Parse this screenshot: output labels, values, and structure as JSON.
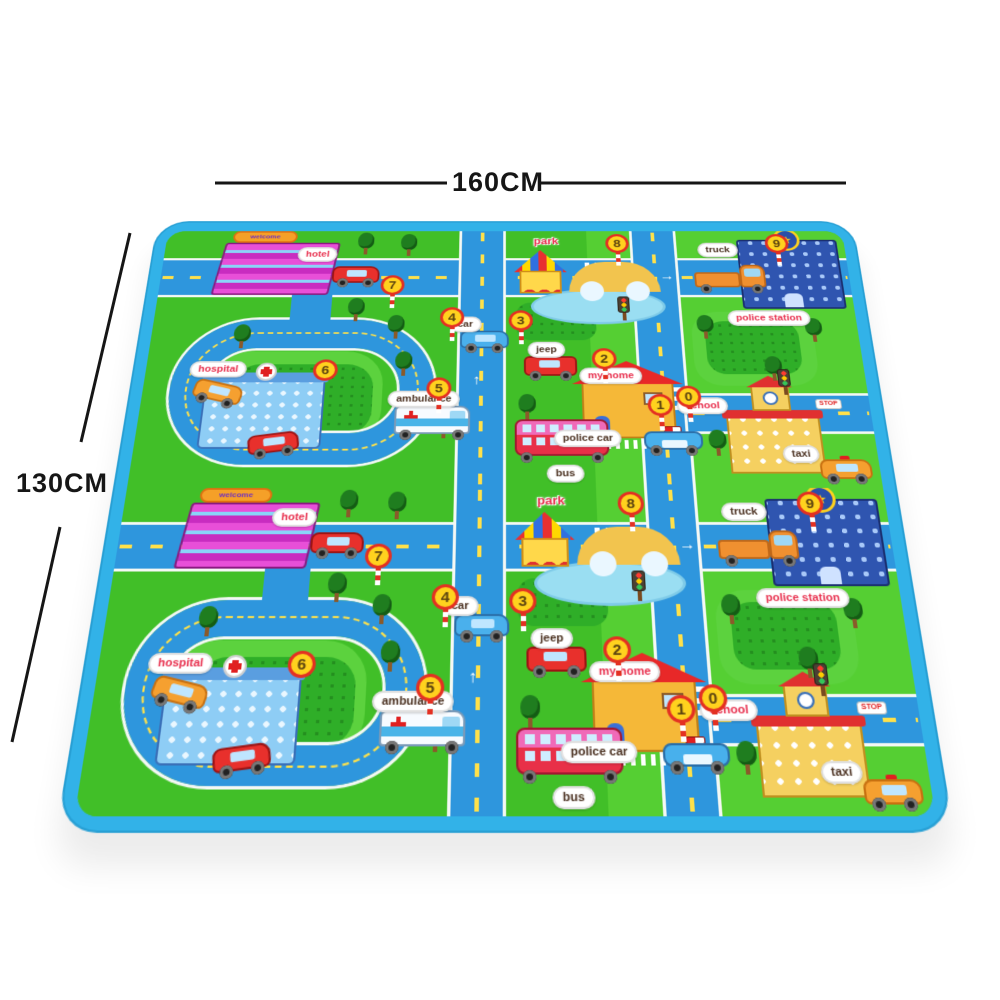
{
  "dimensions": {
    "width_label": "160CM",
    "height_label": "130CM"
  },
  "mat": {
    "labels": {
      "hotel": "hotel",
      "welcome": "welcome",
      "hospital": "hospital",
      "park": "park",
      "truck": "truck",
      "police_station": "police station",
      "school": "school",
      "my_home": "my home",
      "jeep": "jeep",
      "bus": "bus",
      "taxi": "taxi",
      "car": "car",
      "police_car": "police car",
      "ambulance": "ambulance",
      "stop": "STOP"
    },
    "road_markers": [
      "0",
      "1",
      "2",
      "3",
      "4",
      "5",
      "6",
      "7",
      "8",
      "9"
    ],
    "icons": {
      "arrow_up": "↑",
      "arrow_right": "→",
      "star": "★"
    },
    "colors": {
      "binding_blue": "#32b2e8",
      "grass_green": "#46c52e",
      "road_blue": "#2e96dd",
      "label_red": "#e8304e",
      "marker_yellow": "#ffd21e",
      "marker_ring": "#e33022"
    }
  }
}
